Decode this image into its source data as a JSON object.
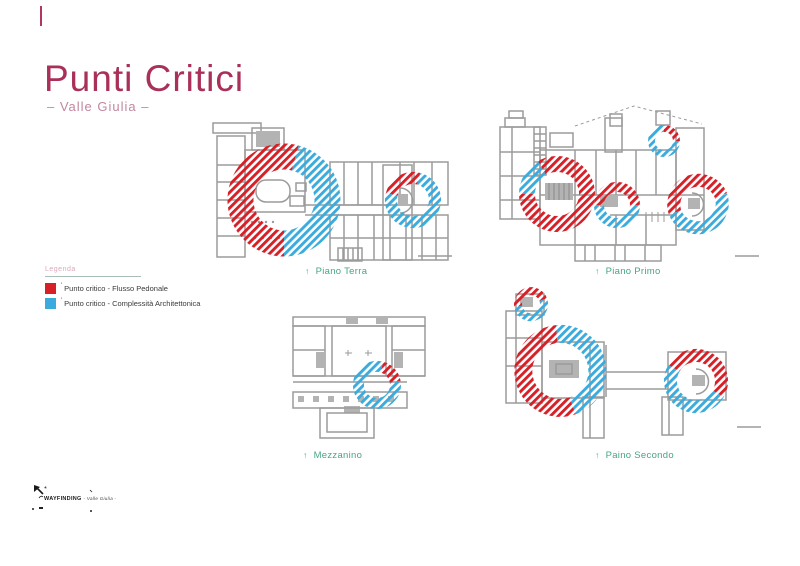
{
  "page": {
    "title": "Punti Critici",
    "subtitle": "– Valle Giulia –"
  },
  "legend": {
    "title": "Legenda",
    "items": [
      {
        "marker": "'",
        "label": "Punto critico - Flusso Pedonale",
        "color": "#d61f26",
        "pattern": "red-diagonal-hatch"
      },
      {
        "marker": "'",
        "label": "Punto critico - Complessità Architettonica",
        "color": "#3aabdc",
        "pattern": "blue-diagonal-hatch"
      }
    ]
  },
  "plans": [
    {
      "id": "piano-terra",
      "arrow": "↑",
      "label": "Piano Terra",
      "critical_points": [
        {
          "size": "large",
          "position": "left",
          "types": [
            "flusso-pedonale",
            "complessita-architettonica"
          ]
        },
        {
          "size": "small",
          "position": "right",
          "types": [
            "flusso-pedonale",
            "complessita-architettonica"
          ]
        }
      ]
    },
    {
      "id": "piano-primo",
      "arrow": "↑",
      "label": "Piano Primo",
      "critical_points": [
        {
          "size": "large",
          "position": "left",
          "types": [
            "flusso-pedonale",
            "complessita-architettonica"
          ]
        },
        {
          "size": "medium",
          "position": "center",
          "types": [
            "flusso-pedonale",
            "complessita-architettonica"
          ]
        },
        {
          "size": "small",
          "position": "top-right",
          "types": [
            "complessita-architettonica",
            "flusso-pedonale"
          ]
        },
        {
          "size": "medium",
          "position": "right",
          "types": [
            "flusso-pedonale",
            "complessita-architettonica"
          ]
        }
      ]
    },
    {
      "id": "mezzanino",
      "arrow": "↑",
      "label": "Mezzanino",
      "critical_points": [
        {
          "size": "small",
          "position": "center-right",
          "types": [
            "complessita-architettonica",
            "flusso-pedonale"
          ]
        }
      ]
    },
    {
      "id": "paino-secondo",
      "arrow": "↑",
      "label": "Paino Secondo",
      "critical_points": [
        {
          "size": "small",
          "position": "top-left",
          "types": [
            "flusso-pedonale",
            "complessita-architettonica"
          ]
        },
        {
          "size": "large",
          "position": "left",
          "types": [
            "flusso-pedonale",
            "complessita-architettonica"
          ]
        },
        {
          "size": "medium",
          "position": "right",
          "types": [
            "flusso-pedonale",
            "complessita-architettonica"
          ]
        }
      ]
    }
  ],
  "footer": {
    "logo_text": "WAYFINDING",
    "logo_sub": "- Valle Giulia -"
  },
  "colors": {
    "accent_pink": "#a93158",
    "subtitle_pink": "#c287a0",
    "legend_title_pink": "#d9a9ba",
    "caption_green": "#47a583",
    "hatch_red": "#d61f26",
    "hatch_blue": "#3aabdc",
    "plan_gray": "#9b9b9b"
  }
}
